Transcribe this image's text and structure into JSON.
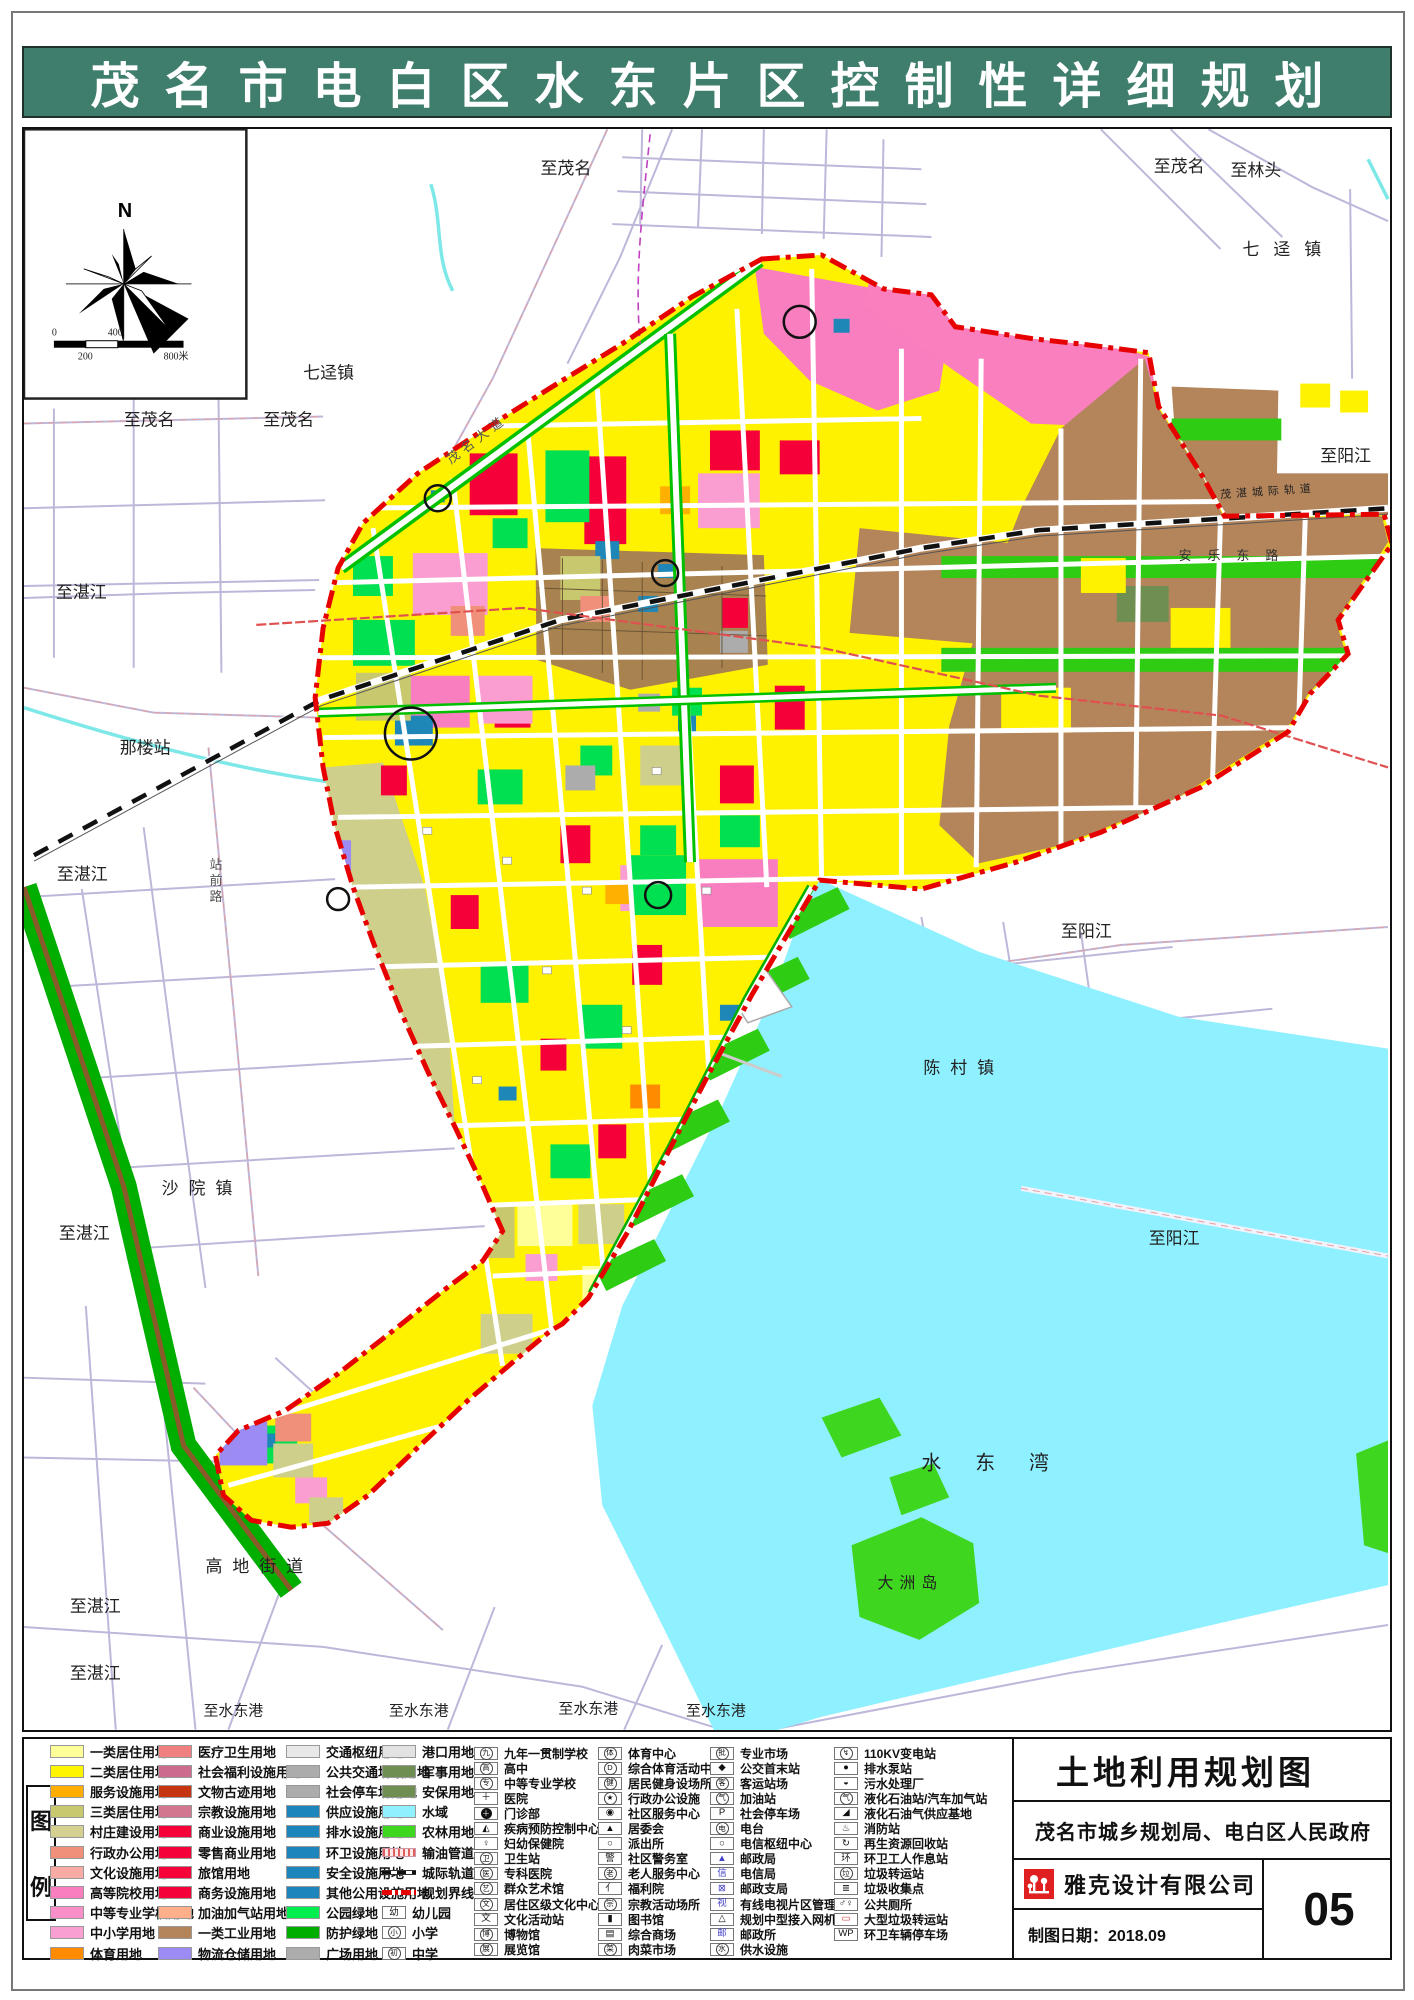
{
  "header": {
    "title": "茂名市电白区水东片区控制性详细规划"
  },
  "map": {
    "compass_north": "N",
    "labels": [
      {
        "t": "至茂名",
        "x": 518,
        "y": 45
      },
      {
        "t": "至茂名",
        "x": 1133,
        "y": 43
      },
      {
        "t": "至林头",
        "x": 1210,
        "y": 47
      },
      {
        "t": "七迳镇",
        "x": 1222,
        "y": 126,
        "ls": 14
      },
      {
        "t": "至茂名",
        "x": 100,
        "y": 297
      },
      {
        "t": "至茂名",
        "x": 240,
        "y": 297
      },
      {
        "t": "七迳镇",
        "x": 280,
        "y": 250
      },
      {
        "t": "至阳江",
        "x": 1300,
        "y": 333
      },
      {
        "t": "至湛江",
        "x": 32,
        "y": 470
      },
      {
        "t": "那楼站",
        "x": 96,
        "y": 626
      },
      {
        "t": "至湛江",
        "x": 33,
        "y": 753
      },
      {
        "t": "陈村镇",
        "x": 902,
        "y": 947,
        "ls": 10
      },
      {
        "t": "至阳江",
        "x": 1040,
        "y": 810
      },
      {
        "t": "至阳江",
        "x": 1128,
        "y": 1118
      },
      {
        "t": "沙院镇",
        "x": 138,
        "y": 1068,
        "ls": 10
      },
      {
        "t": "至湛江",
        "x": 35,
        "y": 1113
      },
      {
        "t": "高地街道",
        "x": 182,
        "y": 1447,
        "ls": 10
      },
      {
        "t": "至湛江",
        "x": 46,
        "y": 1487
      },
      {
        "t": "至湛江",
        "x": 46,
        "y": 1554
      },
      {
        "t": "至水东港",
        "x": 180,
        "y": 1591,
        "fs": 15
      },
      {
        "t": "至水东港",
        "x": 366,
        "y": 1591,
        "fs": 15
      },
      {
        "t": "至水东港",
        "x": 536,
        "y": 1589,
        "fs": 15
      },
      {
        "t": "至水东港",
        "x": 664,
        "y": 1591,
        "fs": 15
      },
      {
        "t": "水东湾",
        "x": 900,
        "y": 1344,
        "fs": 20,
        "ls": 34
      },
      {
        "t": "大洲岛",
        "x": 856,
        "y": 1463,
        "fs": 16,
        "ls": 6
      },
      {
        "t": "安乐东路",
        "x": 1158,
        "y": 432,
        "fs": 13,
        "ls": 16,
        "col": "#333"
      },
      {
        "t": "茂湛城际轨道",
        "x": 1200,
        "y": 370,
        "fs": 11,
        "ls": 5,
        "col": "#222",
        "rot": -4
      },
      {
        "t": "站前路",
        "x": 186,
        "y": 742,
        "fs": 13,
        "v": true,
        "col": "#555"
      },
      {
        "t": "茂名大道",
        "x": 428,
        "y": 336,
        "fs": 13,
        "rot": -37,
        "col": "#555",
        "ls": 5
      },
      {
        "t": "0",
        "x": 28,
        "y": 207,
        "fs": 10
      },
      {
        "t": "400",
        "x": 84,
        "y": 207,
        "fs": 10
      },
      {
        "t": "200",
        "x": 54,
        "y": 231,
        "fs": 10
      },
      {
        "t": "800米",
        "x": 140,
        "y": 231,
        "fs": 10
      }
    ],
    "circles": [
      [
        778,
        193,
        16
      ],
      [
        415,
        370,
        13
      ],
      [
        643,
        445,
        13
      ],
      [
        388,
        606,
        26
      ],
      [
        315,
        772,
        11
      ],
      [
        636,
        768,
        13
      ]
    ]
  },
  "legend": {
    "section_chars": [
      "图",
      "例"
    ],
    "columns": [
      {
        "type": "color",
        "items": [
          {
            "label": "一类居住用地",
            "color": "#FFFF99"
          },
          {
            "label": "二类居住用地",
            "color": "#FFF500"
          },
          {
            "label": "服务设施用地",
            "color": "#FFAE00"
          },
          {
            "label": "三类居住用地",
            "color": "#C8C86E"
          },
          {
            "label": "村庄建设用地",
            "color": "#D4D08F"
          },
          {
            "label": "行政办公用地",
            "color": "#F0907A"
          },
          {
            "label": "文化设施用地",
            "color": "#F7ABA4"
          },
          {
            "label": "高等院校用地",
            "color": "#F87EC0"
          },
          {
            "label": "中等专业学校用地",
            "color": "#F98FC9"
          },
          {
            "label": "中小学用地",
            "color": "#FA9FD2"
          },
          {
            "label": "体育用地",
            "color": "#FF8C00"
          }
        ]
      },
      {
        "type": "color",
        "items": [
          {
            "label": "医疗卫生用地",
            "color": "#F08080"
          },
          {
            "label": "社会福利设施用地",
            "color": "#CC6B8E"
          },
          {
            "label": "文物古迹用地",
            "color": "#C63511"
          },
          {
            "label": "宗教设施用地",
            "color": "#D2758F"
          },
          {
            "label": "商业设施用地",
            "color": "#F50039"
          },
          {
            "label": "零售商业用地",
            "color": "#F50039"
          },
          {
            "label": "旅馆用地",
            "color": "#F50039"
          },
          {
            "label": "商务设施用地",
            "color": "#F50039"
          },
          {
            "label": "加油加气站用地",
            "color": "#FFB08A"
          },
          {
            "label": "一类工业用地",
            "color": "#B4845A"
          },
          {
            "label": "物流仓储用地",
            "color": "#9C8BF2"
          }
        ]
      },
      {
        "type": "color",
        "items": [
          {
            "label": "交通枢纽用地",
            "color": "#E8E8E8"
          },
          {
            "label": "公共交通场站用地",
            "color": "#ACACAC"
          },
          {
            "label": "社会停车场用地",
            "color": "#ACACAC"
          },
          {
            "label": "供应设施用地",
            "color": "#1C86BC"
          },
          {
            "label": "排水设施用地",
            "color": "#1C86BC"
          },
          {
            "label": "环卫设施用地",
            "color": "#1C86BC"
          },
          {
            "label": "安全设施用地",
            "color": "#1C86BC"
          },
          {
            "label": "其他公用设施用地",
            "color": "#1C86BC"
          },
          {
            "label": "公园绿地",
            "color": "#00EE4E"
          },
          {
            "label": "防护绿地",
            "color": "#00AE00"
          },
          {
            "label": "广场用地",
            "color": "#ACACAC"
          }
        ]
      },
      {
        "type": "mixed",
        "items": [
          {
            "label": "港口用地",
            "swatch": "color",
            "color": "#E2E2E2"
          },
          {
            "label": "军事用地",
            "swatch": "color",
            "color": "#6F8F52"
          },
          {
            "label": "安保用地",
            "swatch": "color",
            "color": "#6F8F52"
          },
          {
            "label": "水域",
            "swatch": "color",
            "color": "#8FF0FF"
          },
          {
            "label": "农林用地",
            "swatch": "color",
            "color": "#3FD61F"
          },
          {
            "label": "输油管道",
            "swatch": "line-oil"
          },
          {
            "label": "城际轨道",
            "swatch": "line-rail"
          },
          {
            "label": "规划界线",
            "swatch": "line-boundary"
          },
          {
            "label": "幼儿园",
            "swatch": "sym",
            "sym": "幼",
            "circled": false
          },
          {
            "label": "小学",
            "swatch": "sym",
            "sym": "小",
            "circled": true
          },
          {
            "label": "中学",
            "swatch": "sym",
            "sym": "初",
            "circled": true
          }
        ]
      },
      {
        "type": "sym",
        "items": [
          {
            "sym": "九",
            "circled": true,
            "label": "九年一贯制学校"
          },
          {
            "sym": "高",
            "circled": true,
            "label": "高中"
          },
          {
            "sym": "专",
            "circled": true,
            "label": "中等专业学校"
          },
          {
            "sym": "＋",
            "circled": false,
            "label": "医院"
          },
          {
            "sym": "＋",
            "disc": true,
            "label": "门诊部"
          },
          {
            "sym": "◭",
            "circled": false,
            "label": "疾病预防控制中心"
          },
          {
            "sym": "♀",
            "circled": false,
            "label": "妇幼保健院"
          },
          {
            "sym": "卫",
            "circled": true,
            "label": "卫生站"
          },
          {
            "sym": "医",
            "circled": true,
            "label": "专科医院"
          },
          {
            "sym": "艺",
            "circled": true,
            "label": "群众艺术馆"
          },
          {
            "sym": "文",
            "circled": true,
            "label": "居住区级文化中心"
          },
          {
            "sym": "文",
            "circled": false,
            "label": "文化活动站"
          },
          {
            "sym": "博",
            "circled": true,
            "label": "博物馆"
          },
          {
            "sym": "展",
            "circled": true,
            "label": "展览馆"
          }
        ]
      },
      {
        "type": "sym",
        "items": [
          {
            "sym": "体",
            "circled": true,
            "label": "体育中心"
          },
          {
            "sym": "D",
            "circled": true,
            "label": "综合体育活动中心"
          },
          {
            "sym": "健",
            "circled": true,
            "label": "居民健身设场所"
          },
          {
            "sym": "★",
            "circled": true,
            "label": "行政办公设施"
          },
          {
            "sym": "◉",
            "circled": false,
            "label": "社区服务中心"
          },
          {
            "sym": "▲",
            "circled": false,
            "label": "居委会"
          },
          {
            "sym": "○",
            "circled": false,
            "label": "派出所"
          },
          {
            "sym": "警",
            "circled": false,
            "label": "社区警务室"
          },
          {
            "sym": "老",
            "circled": true,
            "label": "老人服务中心"
          },
          {
            "sym": "亻",
            "circled": false,
            "label": "福利院"
          },
          {
            "sym": "宗",
            "circled": true,
            "label": "宗教活动场所"
          },
          {
            "sym": "▮",
            "circled": false,
            "label": "图书馆"
          },
          {
            "sym": "▤",
            "circled": false,
            "label": "综合商场"
          },
          {
            "sym": "菜",
            "circled": true,
            "label": "肉菜市场"
          }
        ]
      },
      {
        "type": "sym",
        "items": [
          {
            "sym": "批",
            "circled": true,
            "label": "专业市场"
          },
          {
            "sym": "◆",
            "circled": false,
            "label": "公交首末站"
          },
          {
            "sym": "客",
            "circled": true,
            "label": "客运站场"
          },
          {
            "sym": "气",
            "circled": true,
            "label": "加油站"
          },
          {
            "sym": "P",
            "circled": false,
            "label": "社会停车场"
          },
          {
            "sym": "电",
            "circled": true,
            "label": "电台"
          },
          {
            "sym": "○",
            "circled": false,
            "label": "电信枢纽中心"
          },
          {
            "sym": "▲",
            "circled": false,
            "tint": "blue",
            "label": "邮政局"
          },
          {
            "sym": "信",
            "circled": false,
            "tint": "blue",
            "label": "电信局"
          },
          {
            "sym": "⊠",
            "circled": false,
            "tint": "blue",
            "label": "邮政支局"
          },
          {
            "sym": "视",
            "circled": false,
            "tint": "blue",
            "label": "有线电视片区管理站"
          },
          {
            "sym": "△",
            "circled": false,
            "label": "规划中型接入网机房"
          },
          {
            "sym": "邮",
            "circled": false,
            "tint": "blue",
            "label": "邮政所"
          },
          {
            "sym": "水",
            "circled": true,
            "label": "供水设施"
          }
        ]
      },
      {
        "type": "sym",
        "items": [
          {
            "sym": "↯",
            "circled": true,
            "label": "110KV变电站"
          },
          {
            "sym": "●",
            "circled": false,
            "label": "排水泵站"
          },
          {
            "sym": "◒",
            "circled": false,
            "label": "污水处理厂"
          },
          {
            "sym": "气",
            "circled": true,
            "label": "液化石油站/汽车加气站"
          },
          {
            "sym": "◢",
            "circled": false,
            "label": "液化石油气供应基地"
          },
          {
            "sym": "♨",
            "circled": false,
            "label": "消防站"
          },
          {
            "sym": "↻",
            "circled": false,
            "label": "再生资源回收站"
          },
          {
            "sym": "环",
            "circled": false,
            "label": "环卫工人作息站"
          },
          {
            "sym": "垃",
            "circled": true,
            "label": "垃圾转运站"
          },
          {
            "sym": "≣",
            "circled": false,
            "label": "垃圾收集点"
          },
          {
            "sym": "♂♀",
            "circled": false,
            "label": "公共厕所"
          },
          {
            "sym": "▭",
            "circled": false,
            "tint": "red",
            "label": "大型垃圾转运站"
          },
          {
            "sym": "WP",
            "circled": false,
            "label": "环卫车辆停车场"
          }
        ]
      }
    ]
  },
  "titleblock": {
    "title": "土地利用规划图",
    "agency": "茂名市城乡规划局、电白区人民政府",
    "company": "雅克设计有限公司",
    "date_label": "制图日期：2018.09",
    "page_number": "05"
  }
}
